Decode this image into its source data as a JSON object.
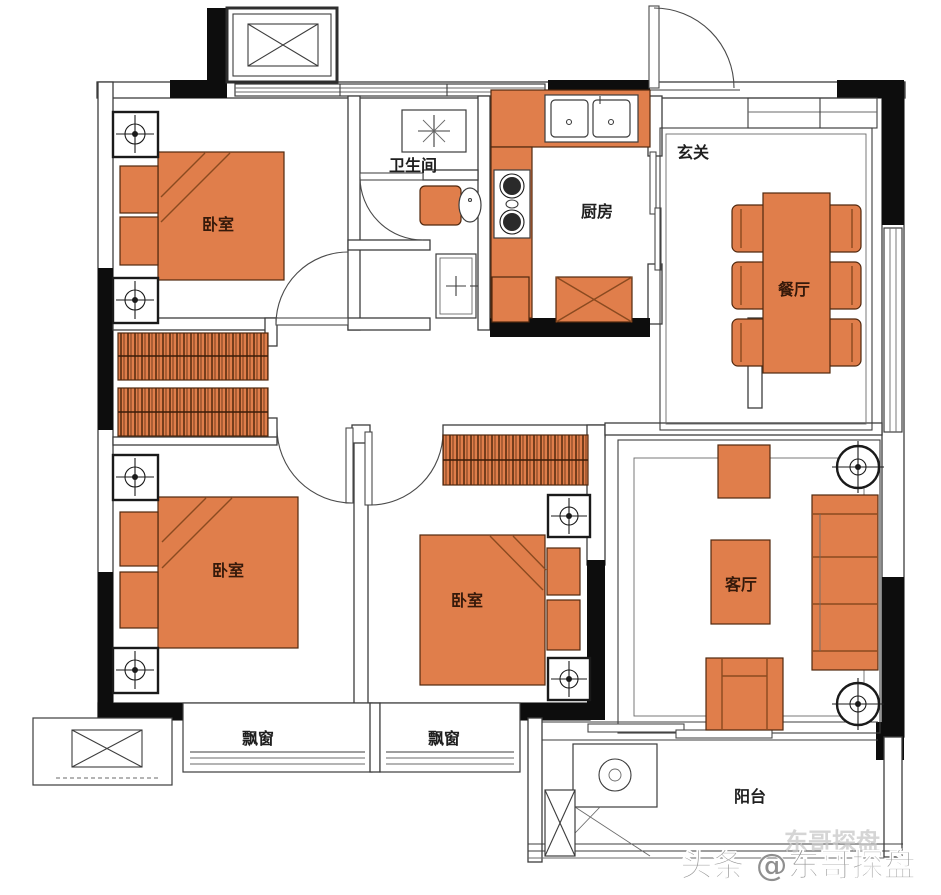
{
  "plan": {
    "type": "apartment-floor-plan",
    "rooms": {
      "bedroom_top_left": {
        "label": "卧室"
      },
      "bedroom_bottom_left": {
        "label": "卧室"
      },
      "bedroom_middle": {
        "label": "卧室"
      },
      "bathroom": {
        "label": "卫生间"
      },
      "kitchen": {
        "label": "厨房"
      },
      "foyer": {
        "label": "玄关"
      },
      "dining": {
        "label": "餐厅"
      },
      "living": {
        "label": "客厅"
      },
      "balcony": {
        "label": "阳台"
      },
      "bay_window_left": {
        "label": "飘窗"
      },
      "bay_window_right": {
        "label": "飘窗"
      }
    }
  },
  "watermark": {
    "text": "头条 @东哥探盘",
    "ghost": "东哥探盘"
  },
  "colors": {
    "furniture": "#E07E4B",
    "wall": "#0d0d0d"
  }
}
